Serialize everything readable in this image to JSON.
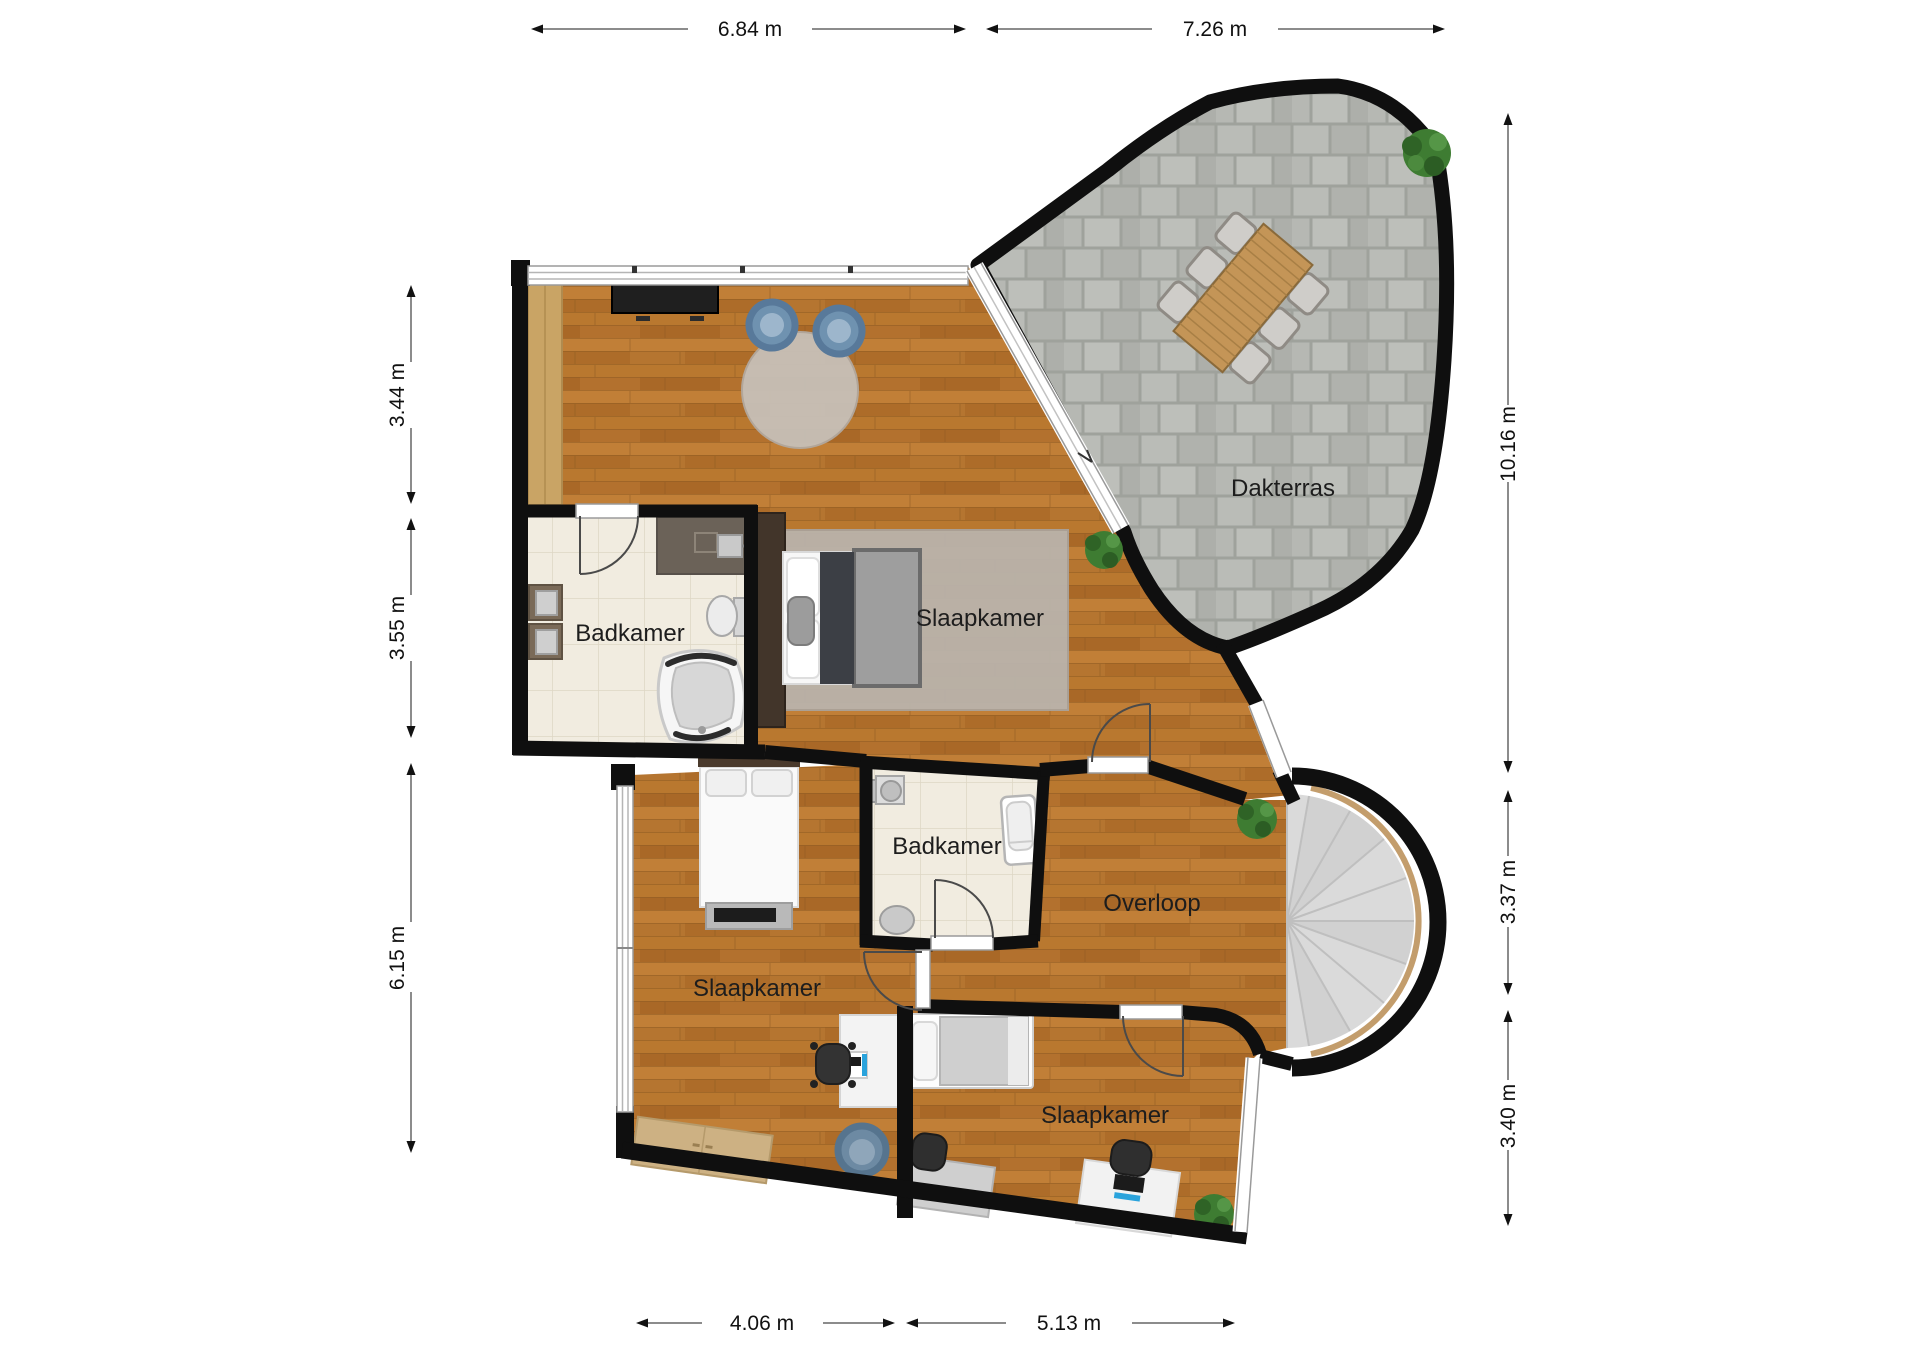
{
  "plan": {
    "rooms": [
      {
        "id": "dakterras",
        "label": "Dakterras"
      },
      {
        "id": "slaapkamer-hoofd",
        "label": "Slaapkamer"
      },
      {
        "id": "badkamer-links",
        "label": "Badkamer"
      },
      {
        "id": "badkamer-midden",
        "label": "Badkamer"
      },
      {
        "id": "overloop",
        "label": "Overloop"
      },
      {
        "id": "slaapkamer-linksonder",
        "label": "Slaapkamer"
      },
      {
        "id": "slaapkamer-rechtsonder",
        "label": "Slaapkamer"
      }
    ],
    "dimensions": {
      "top": [
        "6.84 m",
        "7.26 m"
      ],
      "left": [
        "3.44 m",
        "3.55 m",
        "6.15 m"
      ],
      "right": [
        "10.16 m",
        "3.37 m",
        "3.40 m"
      ],
      "bottom": [
        "4.06 m",
        "5.13 m"
      ]
    },
    "colors": {
      "wall": "#0f0f0f",
      "wood_floor": "#b3722d",
      "light_wood": "#c9a465",
      "bathroom_tile": "#f1ece0",
      "terrace_tile": "#b4b6b1",
      "rug": "#bab3ab",
      "stair": "#dadada",
      "chair_blue": "#7b97b2",
      "monitor_accent": "#2aa3dc"
    }
  }
}
